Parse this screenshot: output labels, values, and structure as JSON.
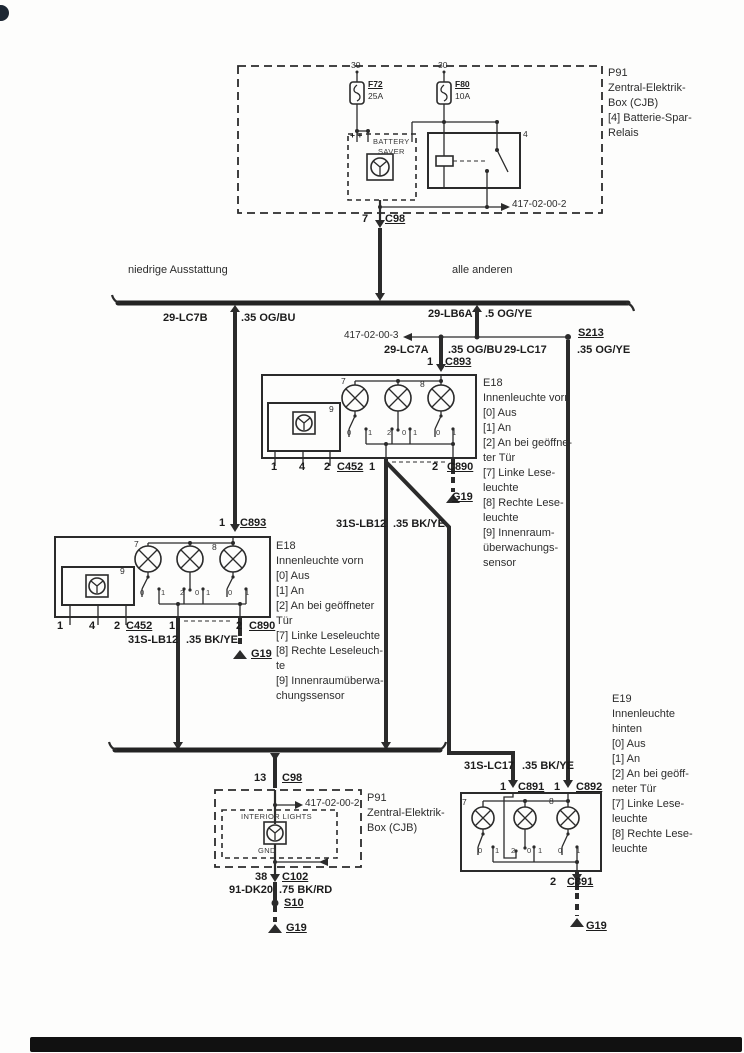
{
  "colors": {
    "ink": "#2b2b2b",
    "paper": "#fdfdfc"
  },
  "sections": [
    {
      "name": "cjb-top",
      "labels": [
        {
          "name": "fuse-f72-pin30",
          "t": "30",
          "x": 351,
          "y": 61,
          "c": "xs"
        },
        {
          "name": "fuse-f72-id",
          "t": "F72",
          "x": 368,
          "y": 80,
          "c": "xs b u"
        },
        {
          "name": "fuse-f72-rating",
          "t": "25A",
          "x": 368,
          "y": 92,
          "c": "xs"
        },
        {
          "name": "fuse-f80-pin30",
          "t": "30",
          "x": 438,
          "y": 61,
          "c": "xs"
        },
        {
          "name": "fuse-f80-id",
          "t": "F80",
          "x": 455,
          "y": 80,
          "c": "xs b u"
        },
        {
          "name": "fuse-f80-rating",
          "t": "10A",
          "x": 455,
          "y": 92,
          "c": "xs"
        },
        {
          "name": "battery-saver-plus-marks",
          "t": "+ +",
          "x": 350,
          "y": 131,
          "c": "xs b"
        },
        {
          "name": "battery-saver-title-1",
          "t": "BATTERY",
          "x": 373,
          "y": 138,
          "c": "t7"
        },
        {
          "name": "battery-saver-title-2",
          "t": "SAVER",
          "x": 378,
          "y": 148,
          "c": "t7"
        },
        {
          "name": "relay-pin-4",
          "t": "4",
          "x": 523,
          "y": 130,
          "c": "xs"
        },
        {
          "name": "ref-417-02-00-2-top",
          "t": "417-02-00-2",
          "x": 512,
          "y": 199,
          "c": "s10"
        },
        {
          "name": "p91-top-legend",
          "lines": [
            "P91",
            "Zentral-Elektrik-",
            "Box (CJB)",
            "[4] Batterie-Spar-",
            "Relais"
          ],
          "x": 608,
          "y": 66,
          "c": "legend"
        },
        {
          "name": "c98-pin-7",
          "t": "7",
          "x": 362,
          "y": 213,
          "c": "b"
        },
        {
          "name": "c98-id",
          "t": "C98",
          "x": 385,
          "y": 213,
          "c": "b u"
        }
      ]
    },
    {
      "name": "branch-row",
      "labels": [
        {
          "name": "branch-left-label",
          "t": "niedrige Ausstattung",
          "x": 128,
          "y": 264,
          "c": ""
        },
        {
          "name": "branch-right-label",
          "t": "alle anderen",
          "x": 452,
          "y": 264,
          "c": ""
        }
      ]
    },
    {
      "name": "splice-row",
      "labels": [
        {
          "name": "wire-29-lc7b",
          "t": "29-LC7B",
          "x": 163,
          "y": 312,
          "c": "b"
        },
        {
          "name": "wire-29-lc7b-gauge",
          "t": ".35 OG/BU",
          "x": 241,
          "y": 312,
          "c": "b"
        },
        {
          "name": "wire-29-lb6a",
          "t": "29-LB6A",
          "x": 428,
          "y": 308,
          "c": "b"
        },
        {
          "name": "wire-29-lb6a-gauge",
          "t": ".5 OG/YE",
          "x": 485,
          "y": 308,
          "c": "b"
        },
        {
          "name": "ref-417-02-00-3",
          "t": "417-02-00-3",
          "x": 344,
          "y": 330,
          "c": "s10"
        },
        {
          "name": "splice-s213",
          "t": "S213",
          "x": 578,
          "y": 327,
          "c": "b u"
        },
        {
          "name": "wire-29-lc7a",
          "t": "29-LC7A",
          "x": 384,
          "y": 344,
          "c": "b"
        },
        {
          "name": "wire-29-lc7a-gauge",
          "t": ".35 OG/BU",
          "x": 448,
          "y": 344,
          "c": "b"
        },
        {
          "name": "wire-29-lc17",
          "t": "29-LC17",
          "x": 504,
          "y": 344,
          "c": "b"
        },
        {
          "name": "wire-29-lc17-gauge",
          "t": ".35 OG/YE",
          "x": 577,
          "y": 344,
          "c": "b"
        }
      ]
    },
    {
      "name": "e18-front-right",
      "labels": [
        {
          "name": "c893-pin-1",
          "t": "1",
          "x": 427,
          "y": 356,
          "c": "b"
        },
        {
          "name": "c893-id",
          "t": "C893",
          "x": 445,
          "y": 356,
          "c": "b u"
        },
        {
          "name": "e18-right-legend",
          "lines": [
            "E18",
            "Innenleuchte vorn",
            "[0] Aus",
            "[1] An",
            "[2] An bei geöffne-",
            "ter Tür",
            "[7] Linke Lese-",
            "leuchte",
            "[8] Rechte Lese-",
            "leuchte",
            "[9] Innenraum-",
            "überwachungs-",
            "sensor"
          ],
          "x": 483,
          "y": 376,
          "c": "legend"
        },
        {
          "name": "lamp-7-number",
          "t": "7",
          "x": 341,
          "y": 377,
          "c": "xs"
        },
        {
          "name": "lamp-8-number",
          "t": "8",
          "x": 420,
          "y": 380,
          "c": "xs"
        },
        {
          "name": "sensor-9-number",
          "t": "9",
          "x": 329,
          "y": 405,
          "c": "xs"
        },
        {
          "name": "switch-terminal",
          "t": "0",
          "x": 347,
          "y": 429,
          "c": "t7"
        },
        {
          "name": "switch-terminal",
          "t": "1",
          "x": 368,
          "y": 429,
          "c": "t7"
        },
        {
          "name": "switch-terminal",
          "t": "2",
          "x": 387,
          "y": 429,
          "c": "t7"
        },
        {
          "name": "switch-terminal",
          "t": "0",
          "x": 402,
          "y": 429,
          "c": "t7"
        },
        {
          "name": "switch-terminal",
          "t": "1",
          "x": 413,
          "y": 429,
          "c": "t7"
        },
        {
          "name": "switch-terminal",
          "t": "0",
          "x": 436,
          "y": 429,
          "c": "t7"
        },
        {
          "name": "switch-terminal",
          "t": "1",
          "x": 452,
          "y": 429,
          "c": "t7"
        },
        {
          "name": "pin-number",
          "t": "1",
          "x": 271,
          "y": 461,
          "c": "b"
        },
        {
          "name": "pin-number",
          "t": "4",
          "x": 299,
          "y": 461,
          "c": "b"
        },
        {
          "name": "pin-number",
          "t": "2",
          "x": 324,
          "y": 461,
          "c": "b"
        },
        {
          "name": "c452-id",
          "t": "C452",
          "x": 337,
          "y": 461,
          "c": "b u"
        },
        {
          "name": "pin-number",
          "t": "1",
          "x": 369,
          "y": 461,
          "c": "b"
        },
        {
          "name": "pin-number",
          "t": "2",
          "x": 432,
          "y": 461,
          "c": "b"
        },
        {
          "name": "c890-id",
          "t": "C890",
          "x": 447,
          "y": 461,
          "c": "b u"
        },
        {
          "name": "ground-g19",
          "t": "G19",
          "x": 452,
          "y": 491,
          "c": "b u"
        },
        {
          "name": "wire-31s-lb12",
          "t": "31S-LB12",
          "x": 336,
          "y": 518,
          "c": "b"
        },
        {
          "name": "wire-31s-lb12-gauge",
          "t": ".35 BK/YE",
          "x": 393,
          "y": 518,
          "c": "b"
        }
      ]
    },
    {
      "name": "e18-front-left",
      "labels": [
        {
          "name": "c893-pin-1",
          "t": "1",
          "x": 219,
          "y": 517,
          "c": "b"
        },
        {
          "name": "c893-id",
          "t": "C893",
          "x": 240,
          "y": 517,
          "c": "b u"
        },
        {
          "name": "e18-left-legend",
          "lines": [
            "E18",
            "Innenleuchte vorn",
            "[0] Aus",
            "[1] An",
            "[2] An bei geöffneter",
            "Tür",
            "[7] Linke Leseleuchte",
            "[8] Rechte Leseleuch-",
            "te",
            "[9] Innenraumüberwa-",
            "chungssensor"
          ],
          "x": 276,
          "y": 539,
          "c": "legend"
        },
        {
          "name": "lamp-7-number",
          "t": "7",
          "x": 134,
          "y": 540,
          "c": "xs"
        },
        {
          "name": "lamp-8-number",
          "t": "8",
          "x": 212,
          "y": 543,
          "c": "xs"
        },
        {
          "name": "sensor-9-number",
          "t": "9",
          "x": 120,
          "y": 567,
          "c": "xs"
        },
        {
          "name": "switch-terminal",
          "t": "0",
          "x": 140,
          "y": 589,
          "c": "t7"
        },
        {
          "name": "switch-terminal",
          "t": "1",
          "x": 161,
          "y": 589,
          "c": "t7"
        },
        {
          "name": "switch-terminal",
          "t": "2",
          "x": 180,
          "y": 589,
          "c": "t7"
        },
        {
          "name": "switch-terminal",
          "t": "0",
          "x": 195,
          "y": 589,
          "c": "t7"
        },
        {
          "name": "switch-terminal",
          "t": "1",
          "x": 206,
          "y": 589,
          "c": "t7"
        },
        {
          "name": "switch-terminal",
          "t": "0",
          "x": 228,
          "y": 589,
          "c": "t7"
        },
        {
          "name": "switch-terminal",
          "t": "1",
          "x": 245,
          "y": 589,
          "c": "t7"
        },
        {
          "name": "pin-number",
          "t": "1",
          "x": 57,
          "y": 620,
          "c": "b"
        },
        {
          "name": "pin-number",
          "t": "4",
          "x": 89,
          "y": 620,
          "c": "b"
        },
        {
          "name": "pin-number",
          "t": "2",
          "x": 114,
          "y": 620,
          "c": "b"
        },
        {
          "name": "c452-id",
          "t": "C452",
          "x": 126,
          "y": 620,
          "c": "b u"
        },
        {
          "name": "pin-number",
          "t": "1",
          "x": 169,
          "y": 620,
          "c": "b"
        },
        {
          "name": "pin-number",
          "t": "2",
          "x": 236,
          "y": 620,
          "c": "b"
        },
        {
          "name": "c890-id",
          "t": "C890",
          "x": 249,
          "y": 620,
          "c": "b u"
        },
        {
          "name": "wire-31s-lb12",
          "t": "31S-LB12",
          "x": 128,
          "y": 634,
          "c": "b"
        },
        {
          "name": "wire-31s-lb12-gauge",
          "t": ".35 BK/YE",
          "x": 186,
          "y": 634,
          "c": "b"
        },
        {
          "name": "ground-g19",
          "t": "G19",
          "x": 251,
          "y": 648,
          "c": "b u"
        }
      ]
    },
    {
      "name": "cjb-bottom",
      "labels": [
        {
          "name": "c98-pin-13",
          "t": "13",
          "x": 254,
          "y": 772,
          "c": "b"
        },
        {
          "name": "c98-id",
          "t": "C98",
          "x": 282,
          "y": 772,
          "c": "b u"
        },
        {
          "name": "ref-417-02-00-2-bottom",
          "t": "417-02-00-2",
          "x": 305,
          "y": 798,
          "c": "s10"
        },
        {
          "name": "p91-bottom-legend",
          "lines": [
            "P91",
            "Zentral-Elektrik-",
            "Box (CJB)"
          ],
          "x": 367,
          "y": 791,
          "c": "legend"
        },
        {
          "name": "interior-lights-title",
          "t": "INTERIOR LIGHTS",
          "x": 241,
          "y": 813,
          "c": "t7"
        },
        {
          "name": "gnd-label",
          "t": "GND",
          "x": 258,
          "y": 847,
          "c": "t7"
        },
        {
          "name": "c102-pin-38",
          "t": "38",
          "x": 255,
          "y": 871,
          "c": "b"
        },
        {
          "name": "c102-id",
          "t": "C102",
          "x": 282,
          "y": 871,
          "c": "b u"
        },
        {
          "name": "wire-91-dk20",
          "t": "91-DK20",
          "x": 229,
          "y": 884,
          "c": "b"
        },
        {
          "name": "wire-91-dk20-gauge",
          "t": ".75 BK/RD",
          "x": 279,
          "y": 884,
          "c": "b"
        },
        {
          "name": "splice-s10",
          "t": "S10",
          "x": 284,
          "y": 897,
          "c": "b u"
        },
        {
          "name": "ground-g19",
          "t": "G19",
          "x": 286,
          "y": 922,
          "c": "b u"
        }
      ]
    },
    {
      "name": "e19-rear",
      "labels": [
        {
          "name": "wire-31s-lc17",
          "t": "31S-LC17",
          "x": 464,
          "y": 760,
          "c": "b"
        },
        {
          "name": "wire-31s-lc17-gauge",
          "t": ".35 BK/YE",
          "x": 522,
          "y": 760,
          "c": "b"
        },
        {
          "name": "c891-pin-1",
          "t": "1",
          "x": 500,
          "y": 781,
          "c": "b"
        },
        {
          "name": "c891-id",
          "t": "C891",
          "x": 518,
          "y": 781,
          "c": "b u"
        },
        {
          "name": "c892-pin-1",
          "t": "1",
          "x": 554,
          "y": 781,
          "c": "b"
        },
        {
          "name": "c892-id",
          "t": "C892",
          "x": 576,
          "y": 781,
          "c": "b u"
        },
        {
          "name": "e19-legend",
          "lines": [
            "E19",
            "Innenleuchte",
            "hinten",
            "[0] Aus",
            "[1] An",
            "[2] An bei geöff-",
            "neter Tür",
            "[7] Linke Lese-",
            "leuchte",
            "[8] Rechte Lese-",
            "leuchte"
          ],
          "x": 612,
          "y": 692,
          "c": "legend"
        },
        {
          "name": "lamp-7-number",
          "t": "7",
          "x": 462,
          "y": 798,
          "c": "xs"
        },
        {
          "name": "lamp-8-number",
          "t": "8",
          "x": 549,
          "y": 797,
          "c": "xs"
        },
        {
          "name": "switch-terminal",
          "t": "0",
          "x": 478,
          "y": 847,
          "c": "t7"
        },
        {
          "name": "switch-terminal",
          "t": "1",
          "x": 495,
          "y": 847,
          "c": "t7"
        },
        {
          "name": "switch-terminal",
          "t": "2",
          "x": 511,
          "y": 847,
          "c": "t7"
        },
        {
          "name": "switch-terminal",
          "t": "0",
          "x": 527,
          "y": 847,
          "c": "t7"
        },
        {
          "name": "switch-terminal",
          "t": "1",
          "x": 538,
          "y": 847,
          "c": "t7"
        },
        {
          "name": "switch-terminal",
          "t": "0",
          "x": 558,
          "y": 847,
          "c": "t7"
        },
        {
          "name": "switch-terminal",
          "t": "1",
          "x": 576,
          "y": 847,
          "c": "t7"
        },
        {
          "name": "pin-number",
          "t": "2",
          "x": 550,
          "y": 876,
          "c": "b"
        },
        {
          "name": "c891-id-bottom",
          "t": "C891",
          "x": 567,
          "y": 876,
          "c": "b u"
        },
        {
          "name": "ground-g19",
          "t": "G19",
          "x": 586,
          "y": 920,
          "c": "b u"
        }
      ]
    }
  ]
}
